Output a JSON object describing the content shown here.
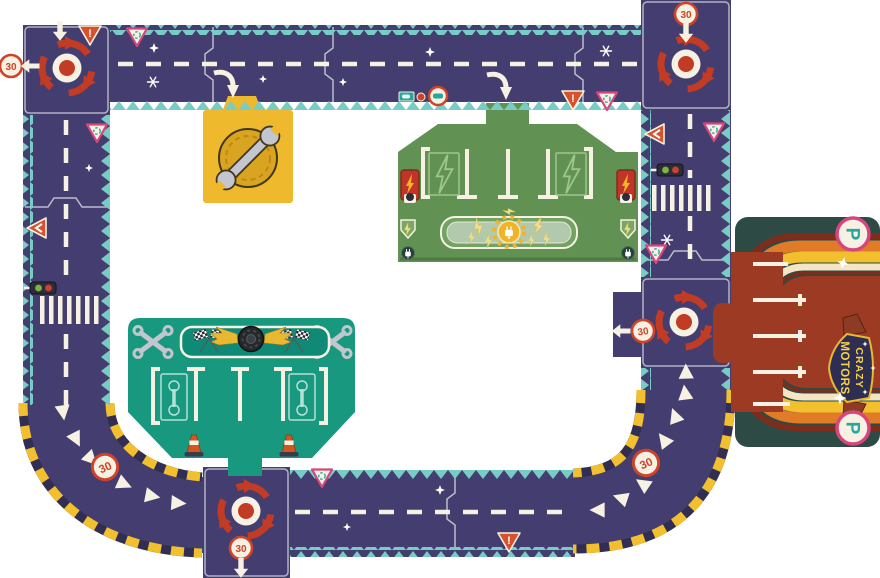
{
  "signs": {
    "speed_limit": "30",
    "warning": "!",
    "parking": "P"
  },
  "logo": {
    "line1": "CRAZY",
    "line2": "MOTORS"
  },
  "colors": {
    "road": "#433e6f",
    "teal": "#79cbc6",
    "cream": "#f6f1e2",
    "arrowRed": "#c23b24",
    "signRed": "#cf4428",
    "pink": "#d6457e",
    "signTeal": "#27a79d",
    "hazY": "#f2c02e",
    "hazD": "#322d52",
    "stGreen": "#619253",
    "stLight": "#9fc68b",
    "gTeal": "#17987f",
    "gDark": "#0f8a76",
    "pkBg": "#2e4a44",
    "brick": "#9c3a24",
    "maroon": "#7e2c1c",
    "orange": "#e07b28",
    "gold": "#d9a41f",
    "pYellow": "#eeb92c",
    "silver": "#c3c6cf",
    "navy": "#2e2d52",
    "logoY": "#f5d34a",
    "cone": "#d2571f"
  },
  "icons": {
    "roundabout-icon": "circular arrows",
    "speed-limit-sign": "30 in red ring",
    "warning-sign": "exclamation triangle",
    "roundabout-warning-sign": "pink triangle with circle arrows",
    "yield-left-sign": "red triangle with left chevron",
    "traffic-light-icon": "green and red lights",
    "pedestrian-crossing": "zebra stripes",
    "direction-arrow-icon": "white arrow",
    "chevron-icon": "white triangle",
    "sparkle-icon": "four point star",
    "snowflake-icon": "six point snowflake",
    "wrench-icon": "wrench over gold ring",
    "crossed-wrenches-icon": "crossed wrenches",
    "checkered-flags-icon": "crossed racing flags",
    "winged-tire-icon": "tire with golden wings",
    "traffic-cone-icon": "orange cone",
    "charging-post-icon": "red post with lightning bolt",
    "lightning-bolt-icon": "lightning bolt",
    "plug-icon": "power plug",
    "parking-sign": "P in circle"
  }
}
